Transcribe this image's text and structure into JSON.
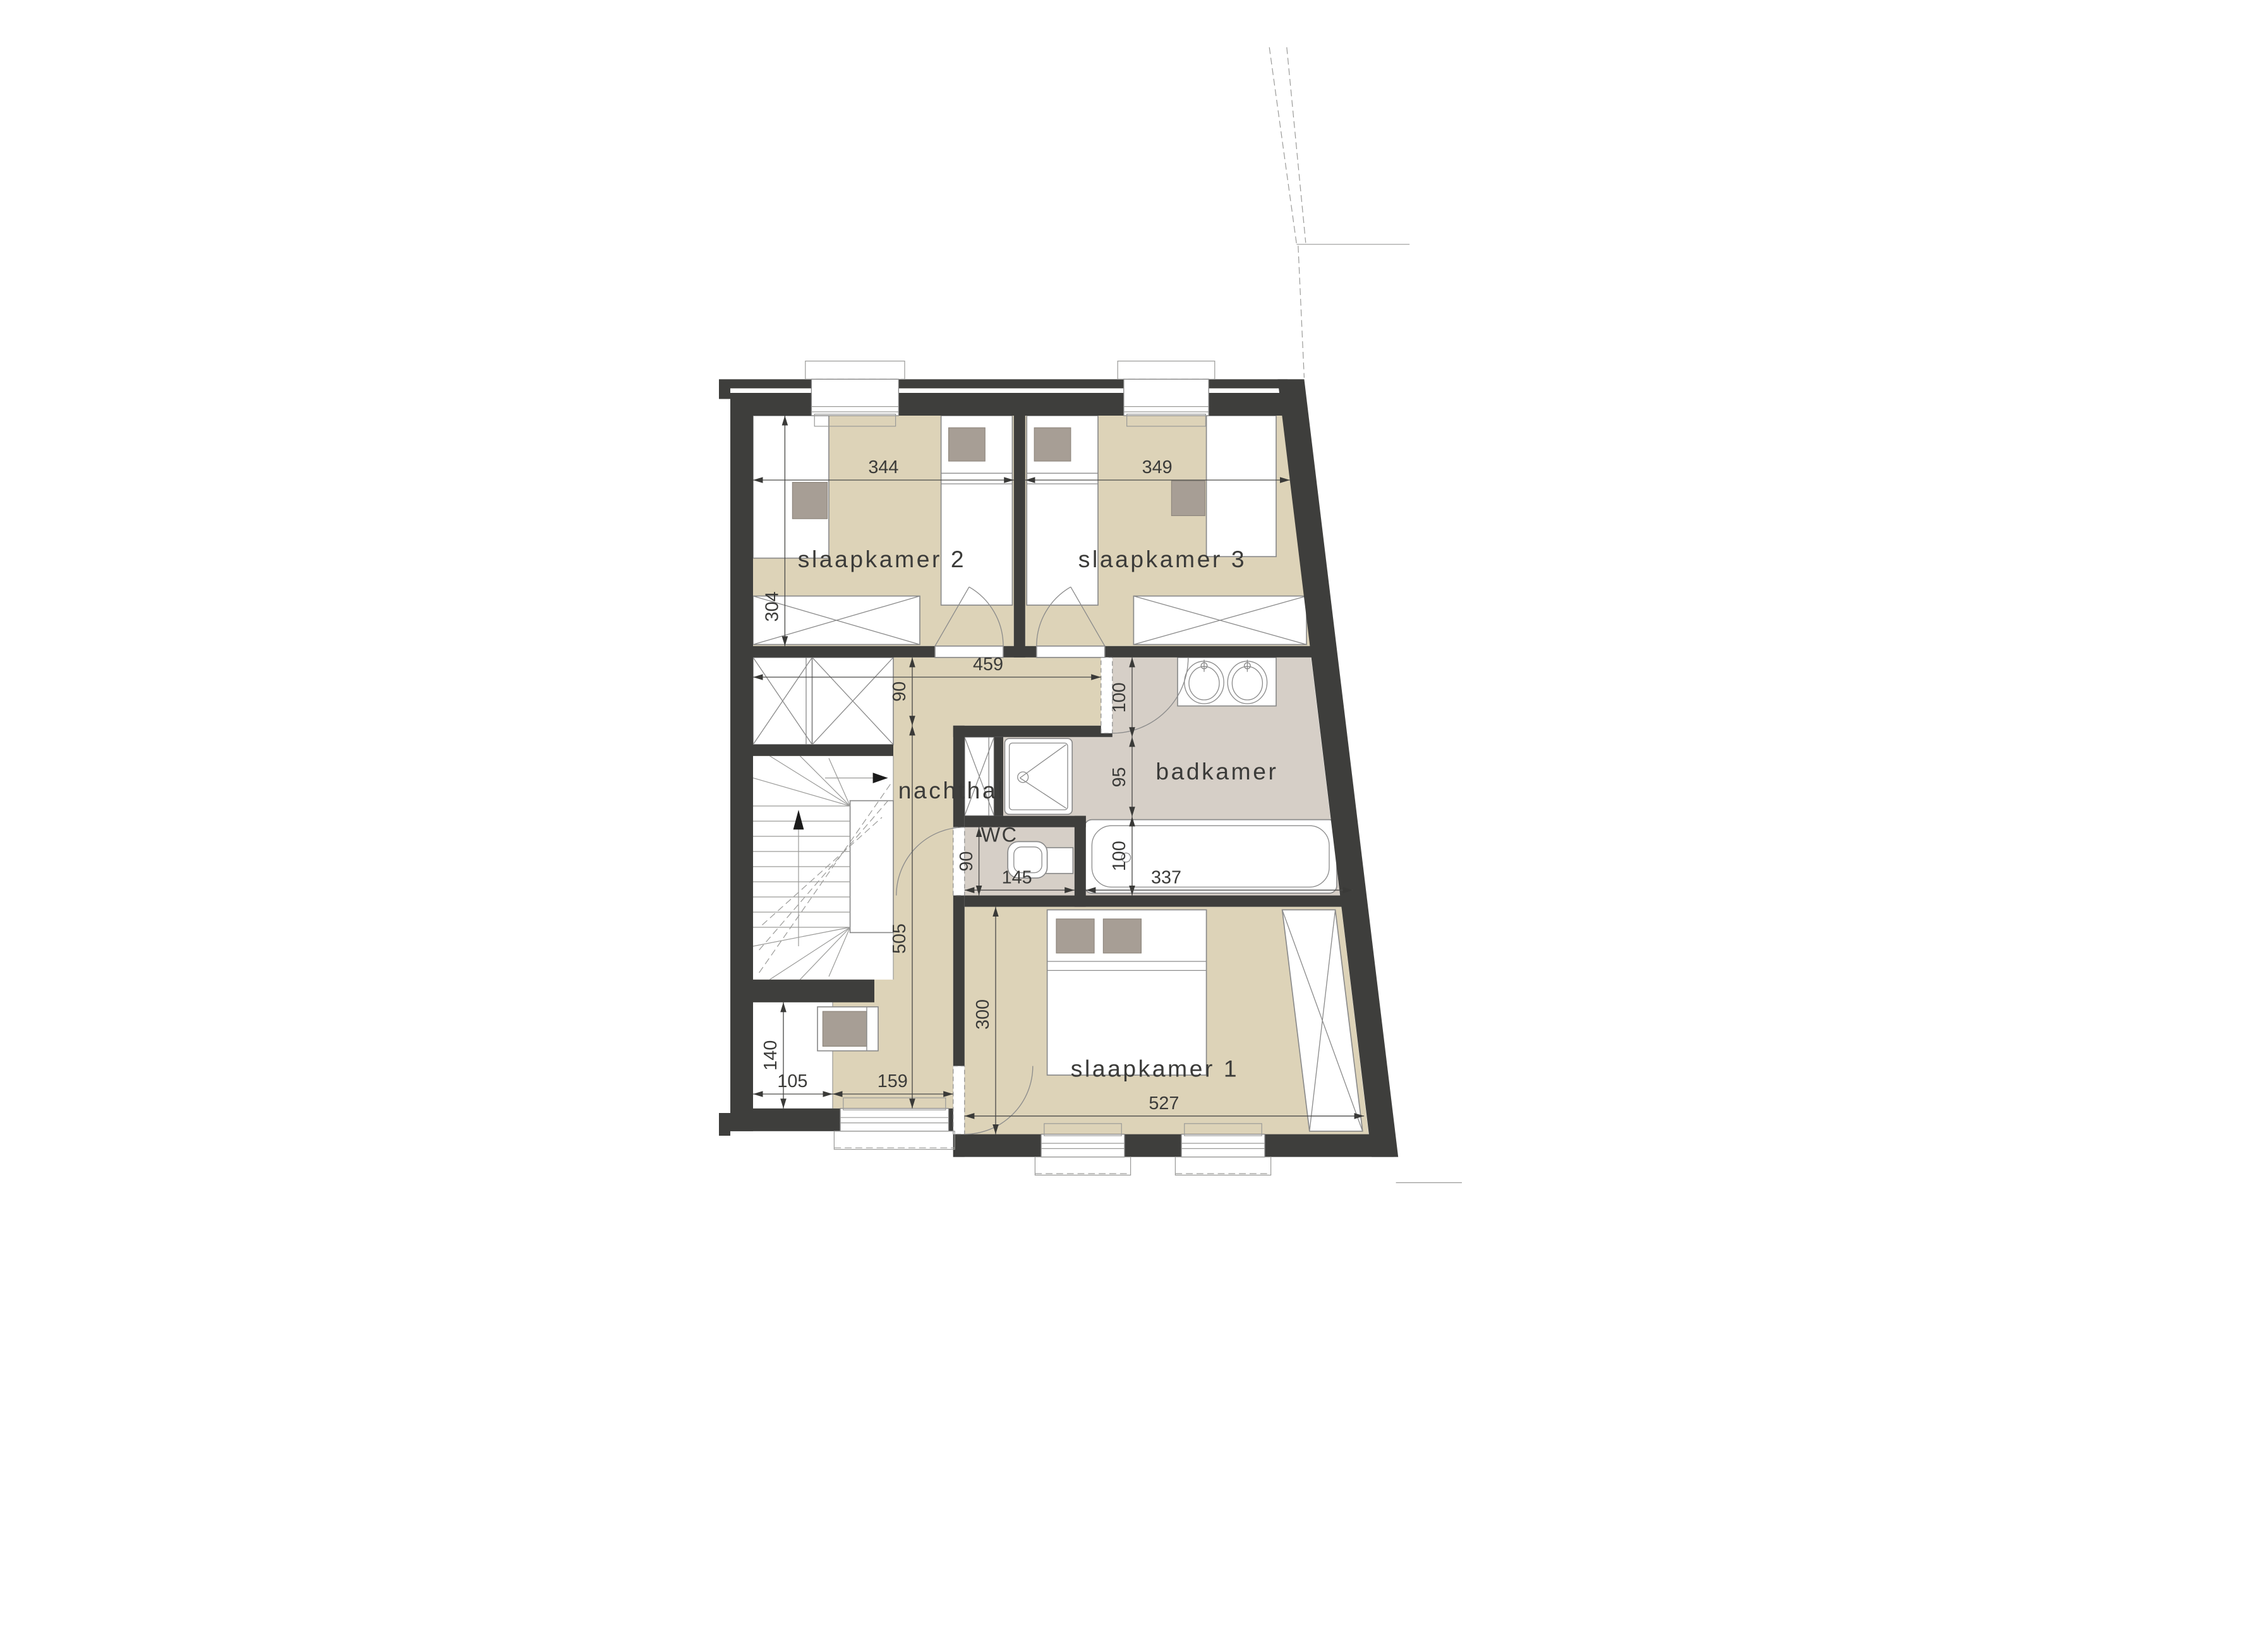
{
  "rooms": {
    "slaapkamer2": {
      "label": "slaapkamer 2"
    },
    "slaapkamer3": {
      "label": "slaapkamer 3"
    },
    "nachthal": {
      "label": "nachthal"
    },
    "badkamer": {
      "label": "badkamer"
    },
    "wc": {
      "label": "WC"
    },
    "slaapkamer1": {
      "label": "slaapkamer 1"
    }
  },
  "dims": {
    "sk2_width": "344",
    "sk3_width": "349",
    "sk2_depth": "304",
    "hall_length": "459",
    "hall_width": "90",
    "hall_depth": "505",
    "bath_top": "100",
    "bath_mid": "95",
    "bath_bottom": "100",
    "tub_length": "337",
    "wc_width": "145",
    "wc_depth": "90",
    "sk1_width": "527",
    "sk1_depth": "300",
    "nook_depth": "140",
    "nook_width": "105",
    "hall_bottom_width": "159"
  },
  "colors": {
    "wall": "#3e3e3c",
    "floor_main": "#ddd3b8",
    "floor_bath": "#d6cfc7",
    "accent": "#a79e95",
    "line": "#8b8b8b",
    "text_color": "#3b3b39"
  }
}
